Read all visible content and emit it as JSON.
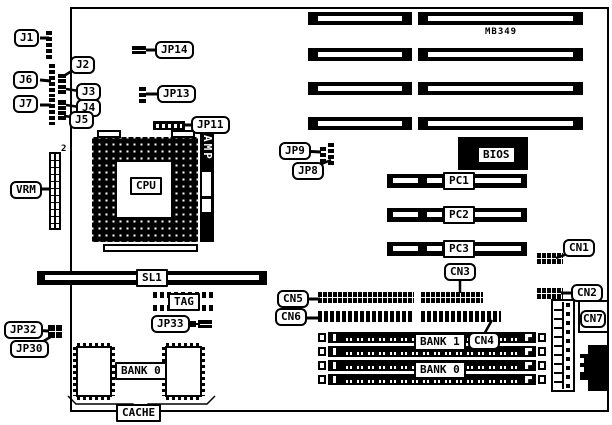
{
  "diagram": {
    "model_label": "MB349",
    "amp_label": "AMP",
    "vrm_pin2_label": "2",
    "callouts": {
      "j1": "J1",
      "j2": "J2",
      "j3": "J3",
      "j4": "J4",
      "j5": "J5",
      "j6": "J6",
      "j7": "J7",
      "jp8": "JP8",
      "jp9": "JP9",
      "jp11": "JP11",
      "jp13": "JP13",
      "jp14": "JP14",
      "jp30": "JP30",
      "jp32": "JP32",
      "jp33": "JP33",
      "vrm": "VRM",
      "cpu": "CPU",
      "sl1": "SL1",
      "tag": "TAG",
      "bios": "BIOS",
      "pc1": "PC1",
      "pc2": "PC2",
      "pc3": "PC3",
      "cn1": "CN1",
      "cn2": "CN2",
      "cn3": "CN3",
      "cn4": "CN4",
      "cn5": "CN5",
      "cn6": "CN6",
      "cn7": "CN7",
      "bank1_memory": "BANK 1",
      "bank0_memory": "BANK 0",
      "bank0_cache": "BANK 0",
      "cache": "CACHE"
    },
    "colors": {
      "ink": "#000000",
      "paper": "#ffffff"
    }
  }
}
